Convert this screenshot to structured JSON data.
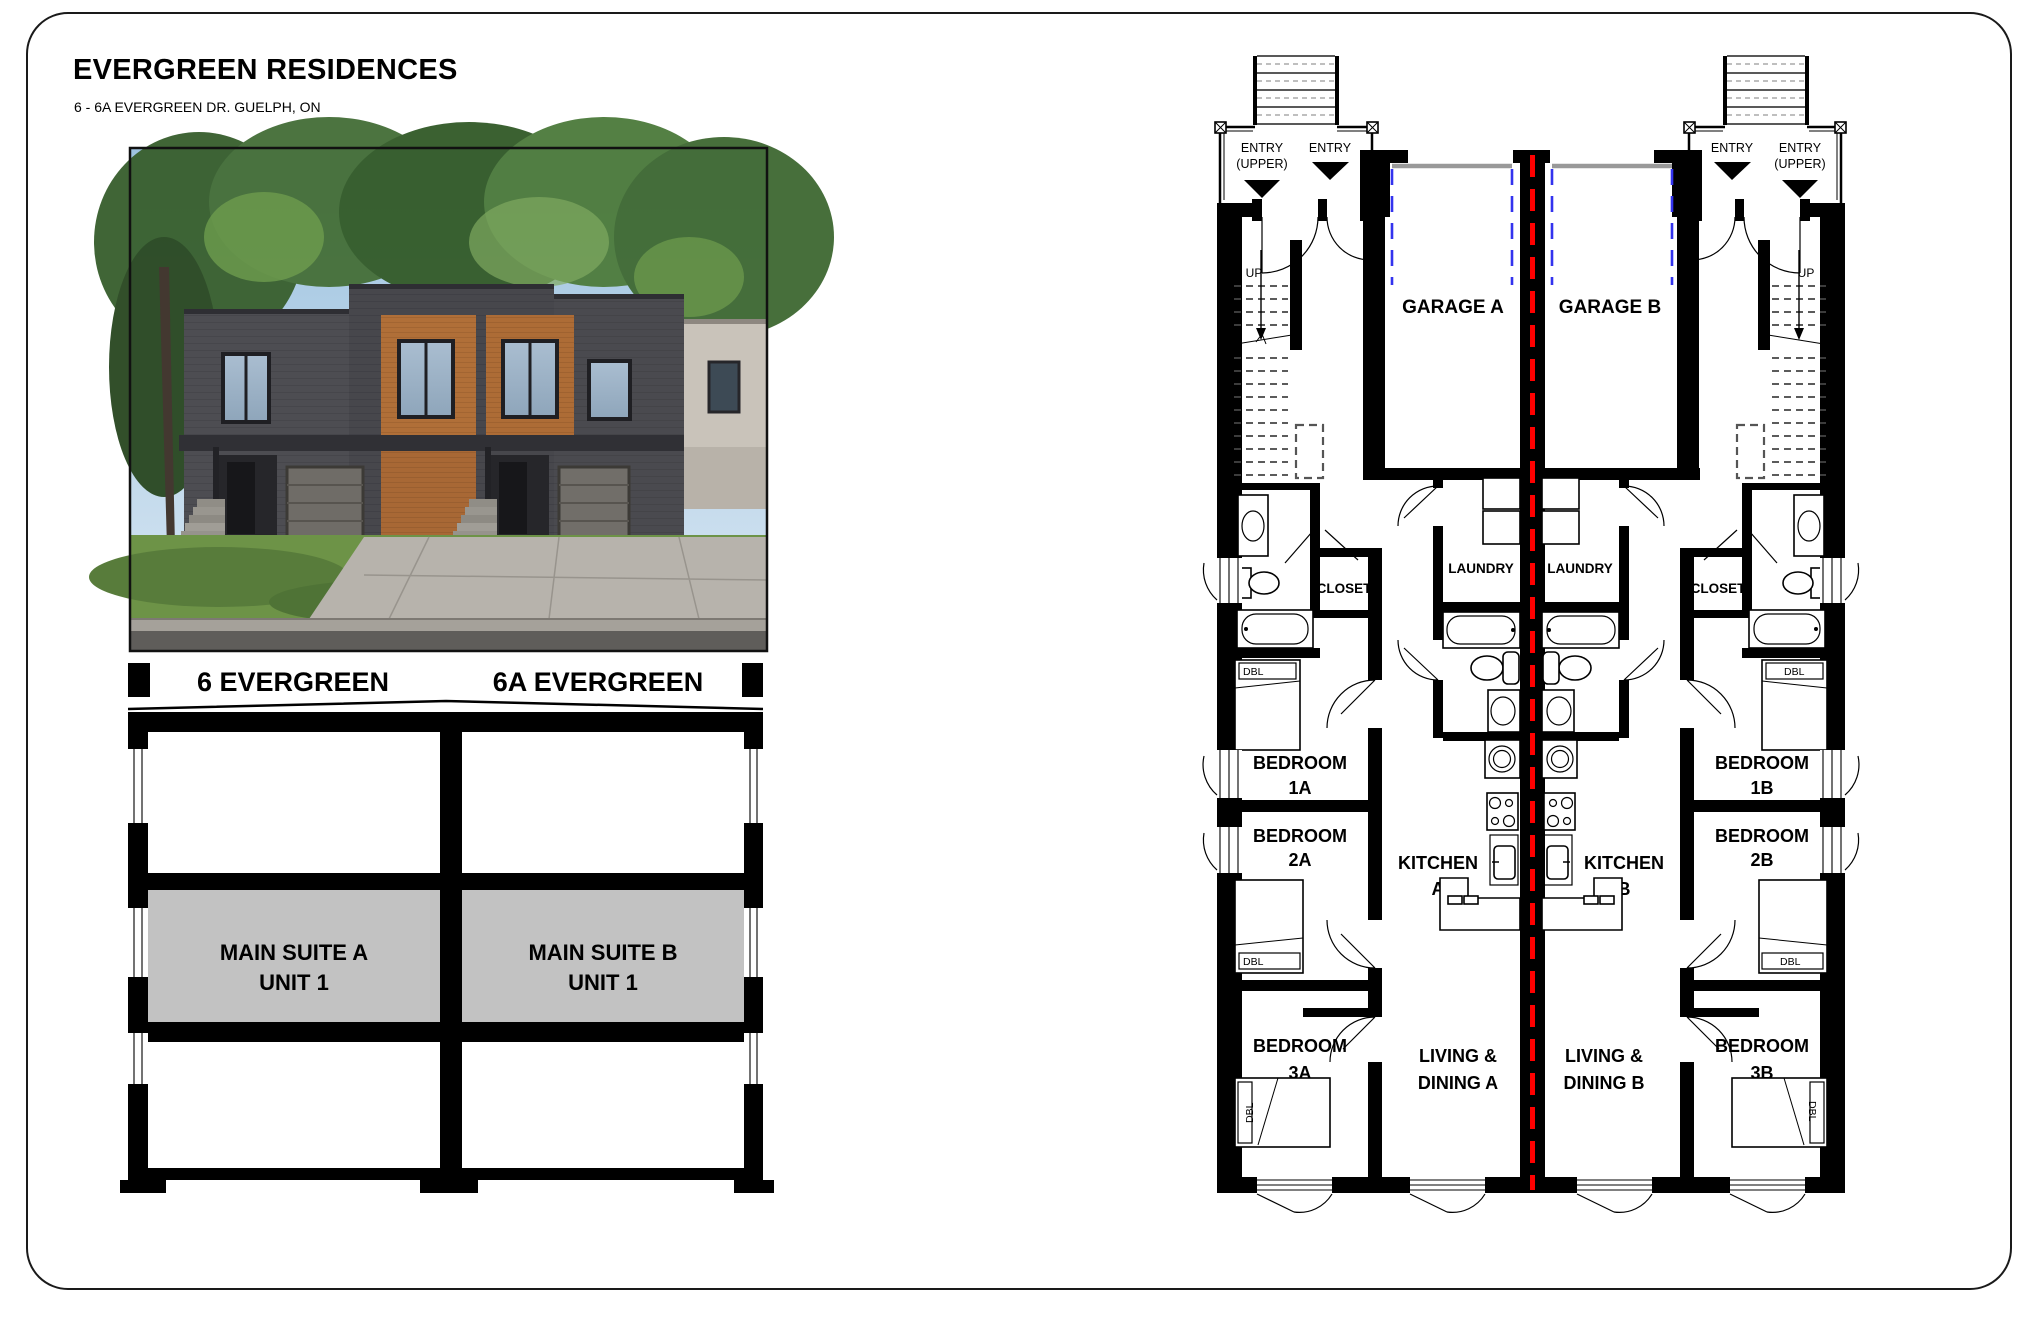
{
  "header": {
    "title": "EVERGREEN RESIDENCES",
    "subtitle": "6 - 6A EVERGREEN DR. GUELPH, ON"
  },
  "section": {
    "left_house_label": "6 EVERGREEN",
    "right_house_label": "6A EVERGREEN",
    "suite_a_line1": "MAIN SUITE A",
    "suite_a_line2": "UNIT 1",
    "suite_b_line1": "MAIN SUITE B",
    "suite_b_line2": "UNIT 1"
  },
  "plan": {
    "entry_label": "ENTRY",
    "entry_upper_suffix": "(UPPER)",
    "up_label": "UP",
    "garage_a": "GARAGE A",
    "garage_b": "GARAGE B",
    "laundry": "LAUNDRY",
    "closet": "CLOSET",
    "bed_tag": "DBL",
    "kitchen": "KITCHEN",
    "kitchen_a_suffix": "A",
    "kitchen_b_suffix": "B",
    "bedroom": "BEDROOM",
    "bedroom_1a": "1A",
    "bedroom_2a": "2A",
    "bedroom_3a": "3A",
    "bedroom_1b": "1B",
    "bedroom_2b": "2B",
    "bedroom_3b": "3B",
    "living": "LIVING &",
    "dining_a": "DINING A",
    "dining_b": "DINING B"
  },
  "colors": {
    "party_wall_line": "#ff0000",
    "garage_door": "#3333ee",
    "garage_header": "#999999",
    "suite_fill": "#c2c2c2"
  }
}
